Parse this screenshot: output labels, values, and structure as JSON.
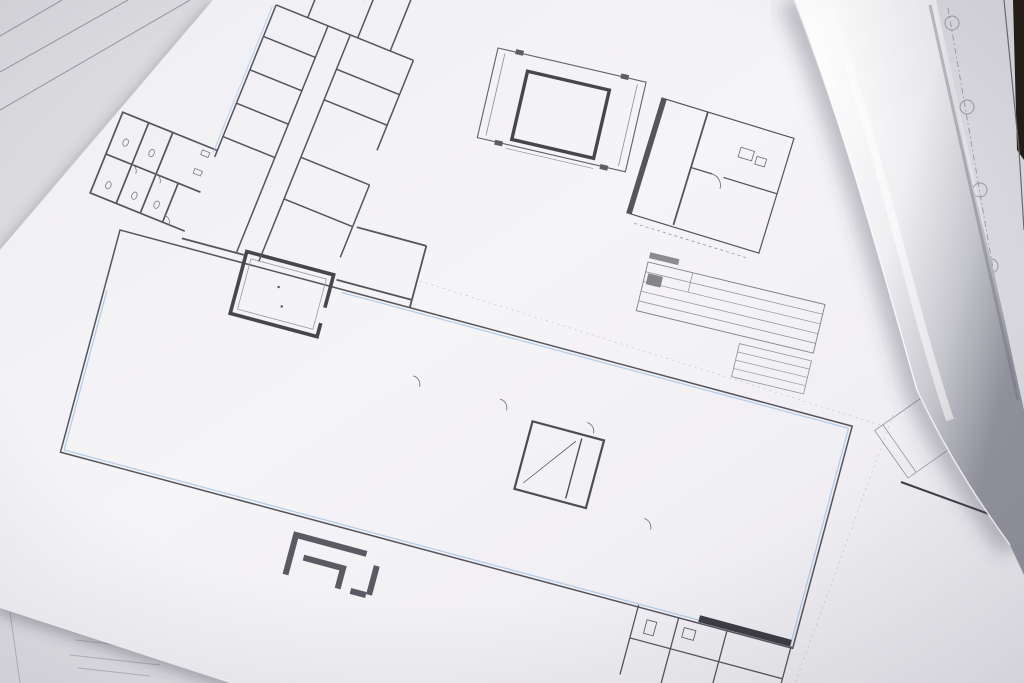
{
  "colors": {
    "paper": "#f4f3f6",
    "under_paper": "#e7e6ea",
    "drawing_line": "#54545c",
    "accent_blue": "#a9c8e6",
    "gray_fill_dark": "#9c9ca3",
    "gray_fill_light": "#c9c9d0",
    "table_surface_dark": "#241c15"
  },
  "plan": {
    "room_numbers": [
      {
        "label": "1",
        "x": 612,
        "y": 403
      },
      {
        "label": "2",
        "x": 662,
        "y": 417
      },
      {
        "label": "3",
        "x": 715,
        "y": 433
      },
      {
        "label": "4",
        "x": 793,
        "y": 458
      },
      {
        "label": "5",
        "x": 773,
        "y": 537
      },
      {
        "label": "6",
        "x": 753,
        "y": 603
      },
      {
        "label": "9",
        "x": 714,
        "y": 664
      },
      {
        "label": "8",
        "x": 735,
        "y": 668
      },
      {
        "label": "10",
        "x": 513,
        "y": 484
      },
      {
        "label": "12",
        "x": 705,
        "y": 483
      },
      {
        "label": "13",
        "x": 697,
        "y": 522
      },
      {
        "label": "14",
        "x": 571,
        "y": 509
      },
      {
        "label": "15",
        "x": 437,
        "y": 403
      },
      {
        "label": "16",
        "x": 427,
        "y": 442
      },
      {
        "label": "17",
        "x": 674,
        "y": 595
      },
      {
        "label": "18",
        "x": 325,
        "y": 409
      },
      {
        "label": "19",
        "x": 451,
        "y": 353
      },
      {
        "label": "20",
        "x": 542,
        "y": 431
      },
      {
        "label": "21",
        "x": 269,
        "y": 464
      },
      {
        "label": "22",
        "x": 140,
        "y": 288
      },
      {
        "label": "23",
        "x": 272,
        "y": 392
      },
      {
        "label": "24",
        "x": 154,
        "y": 429
      },
      {
        "label": "25",
        "x": 177,
        "y": 358
      },
      {
        "label": "26",
        "x": 206,
        "y": 435
      },
      {
        "label": "27",
        "x": 184,
        "y": 267
      },
      {
        "label": "28",
        "x": 209,
        "y": 243
      },
      {
        "label": "29",
        "x": 184,
        "y": 236
      },
      {
        "label": "33",
        "x": 157,
        "y": 240
      },
      {
        "label": "34",
        "x": 135,
        "y": 260
      },
      {
        "label": "35",
        "x": 157,
        "y": 263
      },
      {
        "label": "36",
        "x": 296,
        "y": 240
      },
      {
        "label": "37",
        "x": 353,
        "y": 10
      },
      {
        "label": "39",
        "x": 733,
        "y": 178
      },
      {
        "label": "40",
        "x": 750,
        "y": 213
      }
    ],
    "scale_bar_ticks": [
      "0",
      "1",
      "2",
      "3",
      "4",
      "5",
      "6",
      "7",
      "8",
      "9"
    ],
    "side_table_rows": [
      "17",
      "16",
      "15",
      "14",
      "13",
      "12",
      "11",
      "10"
    ]
  }
}
